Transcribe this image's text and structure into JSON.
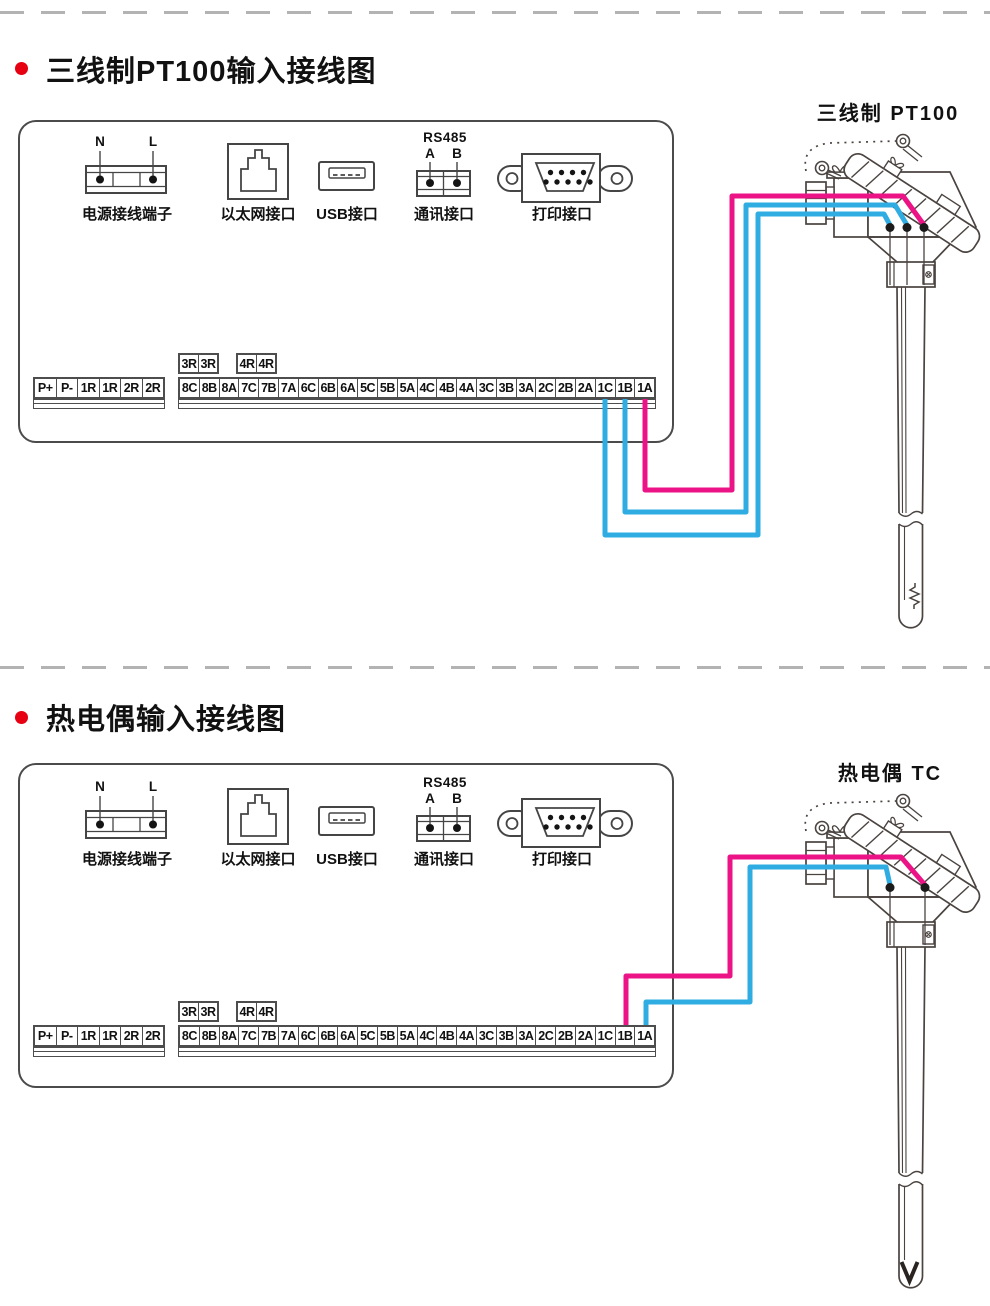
{
  "colors": {
    "wire_pink": "#ec1387",
    "wire_blue": "#2fade3",
    "line_art": "#4a4340",
    "panel_line": "#4b4b4b",
    "bullet_red": "#e60012",
    "divider_gray": "#b3b3b3"
  },
  "sections": [
    {
      "title": "三线制PT100输入接线图",
      "sensor": {
        "label": "三线制 PT100",
        "type": "rtd-3wire",
        "terminal_count": 3
      },
      "panel": {
        "ports": {
          "power": {
            "caption": "电源接线端子",
            "pins": [
              "N",
              "L"
            ]
          },
          "ethernet": {
            "caption": "以太网接口"
          },
          "usb": {
            "caption": "USB接口"
          },
          "rs485": {
            "caption": "通讯接口",
            "heading": "RS485",
            "pins": [
              "A",
              "B"
            ]
          },
          "printer": {
            "caption": "打印接口"
          }
        }
      },
      "terminals": {
        "aux": [
          [
            "3R",
            "3R"
          ],
          [
            "4R",
            "4R"
          ]
        ],
        "left": [
          "P+",
          "P-",
          "1R",
          "1R",
          "2R",
          "2R"
        ],
        "main": [
          "8C",
          "8B",
          "8A",
          "7C",
          "7B",
          "7A",
          "6C",
          "6B",
          "6A",
          "5C",
          "5B",
          "5A",
          "4C",
          "4B",
          "4A",
          "3C",
          "3B",
          "3A",
          "2C",
          "2B",
          "2A",
          "1C",
          "1B",
          "1A"
        ]
      },
      "connections": [
        {
          "terminal": "1A",
          "wire": "pink"
        },
        {
          "terminal": "1B",
          "wire": "blue"
        },
        {
          "terminal": "1C",
          "wire": "blue"
        }
      ]
    },
    {
      "title": "热电偶输入接线图",
      "sensor": {
        "label": "热电偶 TC",
        "type": "thermocouple",
        "terminal_count": 2
      },
      "panel": {
        "ports": {
          "power": {
            "caption": "电源接线端子",
            "pins": [
              "N",
              "L"
            ]
          },
          "ethernet": {
            "caption": "以太网接口"
          },
          "usb": {
            "caption": "USB接口"
          },
          "rs485": {
            "caption": "通讯接口",
            "heading": "RS485",
            "pins": [
              "A",
              "B"
            ]
          },
          "printer": {
            "caption": "打印接口"
          }
        }
      },
      "terminals": {
        "aux": [
          [
            "3R",
            "3R"
          ],
          [
            "4R",
            "4R"
          ]
        ],
        "left": [
          "P+",
          "P-",
          "1R",
          "1R",
          "2R",
          "2R"
        ],
        "main": [
          "8C",
          "8B",
          "8A",
          "7C",
          "7B",
          "7A",
          "6C",
          "6B",
          "6A",
          "5C",
          "5B",
          "5A",
          "4C",
          "4B",
          "4A",
          "3C",
          "3B",
          "3A",
          "2C",
          "2B",
          "2A",
          "1C",
          "1B",
          "1A"
        ]
      },
      "connections": [
        {
          "terminal": "1B",
          "wire": "pink"
        },
        {
          "terminal": "1A",
          "wire": "blue"
        }
      ]
    }
  ]
}
